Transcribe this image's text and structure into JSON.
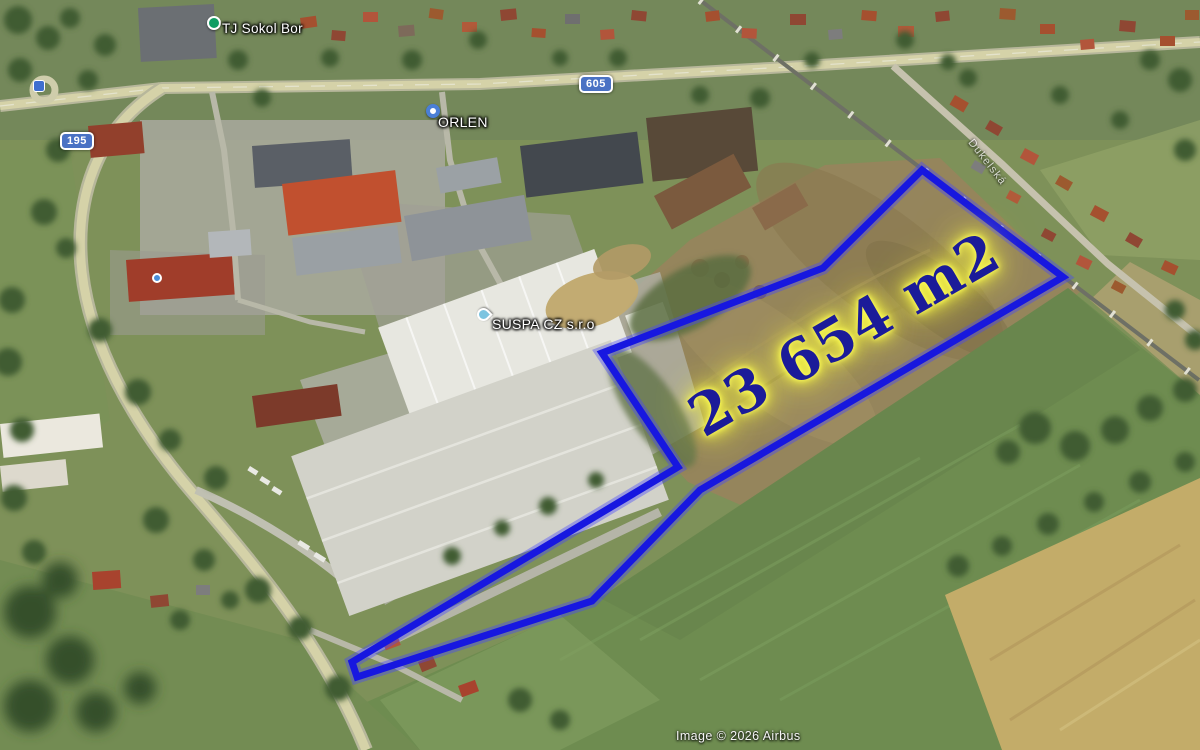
{
  "map": {
    "area_label": "23 654 m2",
    "street_label": "Dukelská",
    "watermark": "Image © 2026 Airbus",
    "road_shields": [
      {
        "number": "195"
      },
      {
        "number": "605"
      }
    ],
    "pois": [
      {
        "name": "TJ Sokol Bor",
        "icon": "green-dot"
      },
      {
        "name": "ORLEN",
        "icon": "fuel-station-dot"
      },
      {
        "name": "SUSPA CZ s.r.o",
        "icon": "teal-pin"
      }
    ],
    "plot": {
      "outline_points": "922,170 1063,277 700,490 592,601 357,677 352,662 678,467 602,353 823,268",
      "outline_color": "#1717e0",
      "label_color": "#1b1b99",
      "glow_color": "#ffff45"
    }
  }
}
